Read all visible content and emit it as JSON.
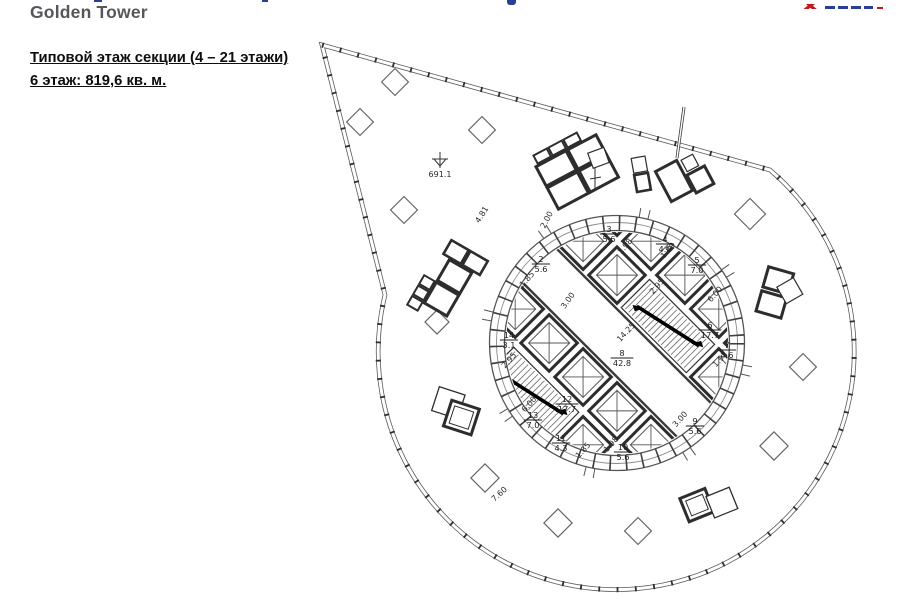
{
  "header": {
    "subtitle": "Golden Tower"
  },
  "titles": {
    "line1": "Типовой этаж секции (4 – 21 этажи)",
    "line2": "6 этаж: 819,6 кв. м."
  },
  "colors": {
    "accent_blue": "#2b3f92",
    "logo_red": "#c4161c",
    "subtitle_gray": "#55575a",
    "drawing_line": "#3a3a3a"
  },
  "plan": {
    "level_mark": "691.1",
    "rooms": [
      {
        "n": "2",
        "a": "5.6",
        "x": 541,
        "y": 264
      },
      {
        "n": "3",
        "a": "5.6",
        "x": 609,
        "y": 234
      },
      {
        "n": "4",
        "a": "4.0",
        "x": 665,
        "y": 244
      },
      {
        "n": "5",
        "a": "7.0",
        "x": 697,
        "y": 265
      },
      {
        "n": "6",
        "a": "17.7",
        "x": 710,
        "y": 330
      },
      {
        "n": "7",
        "a": "4.6",
        "x": 727,
        "y": 350
      },
      {
        "n": "8",
        "a": "42.8",
        "x": 622,
        "y": 358
      },
      {
        "n": "9",
        "a": "5.6",
        "x": 695,
        "y": 426
      },
      {
        "n": "10",
        "a": "5.6",
        "x": 623,
        "y": 452
      },
      {
        "n": "11",
        "a": "4.3",
        "x": 561,
        "y": 443
      },
      {
        "n": "12",
        "a": "17.7",
        "x": 567,
        "y": 404
      },
      {
        "n": "13",
        "a": "7.0",
        "x": 533,
        "y": 420
      },
      {
        "n": "14",
        "a": "3.1",
        "x": 509,
        "y": 340
      }
    ],
    "dimensions": [
      {
        "t": "4.81",
        "x": 484,
        "y": 216,
        "r": -58
      },
      {
        "t": "2.00",
        "x": 549,
        "y": 221,
        "r": -62
      },
      {
        "t": "1.98",
        "x": 627,
        "y": 248,
        "r": -50
      },
      {
        "t": "1.89",
        "x": 670,
        "y": 252,
        "r": -50
      },
      {
        "t": "2.95",
        "x": 659,
        "y": 288,
        "r": -48
      },
      {
        "t": "6.00",
        "x": 717,
        "y": 296,
        "r": -48
      },
      {
        "t": "1.85",
        "x": 529,
        "y": 281,
        "r": -48
      },
      {
        "t": "3.00",
        "x": 570,
        "y": 302,
        "r": -55
      },
      {
        "t": "14.25",
        "x": 628,
        "y": 334,
        "r": -47
      },
      {
        "t": "2.95",
        "x": 511,
        "y": 362,
        "r": -48
      },
      {
        "t": "6.00",
        "x": 531,
        "y": 406,
        "r": -48
      },
      {
        "t": "1.97",
        "x": 722,
        "y": 361,
        "r": -48
      },
      {
        "t": "1.98",
        "x": 613,
        "y": 446,
        "r": -48
      },
      {
        "t": "1.85",
        "x": 585,
        "y": 452,
        "r": -48
      },
      {
        "t": "3.00",
        "x": 682,
        "y": 421,
        "r": -48
      },
      {
        "t": "7.60",
        "x": 501,
        "y": 496,
        "r": -42
      }
    ]
  }
}
